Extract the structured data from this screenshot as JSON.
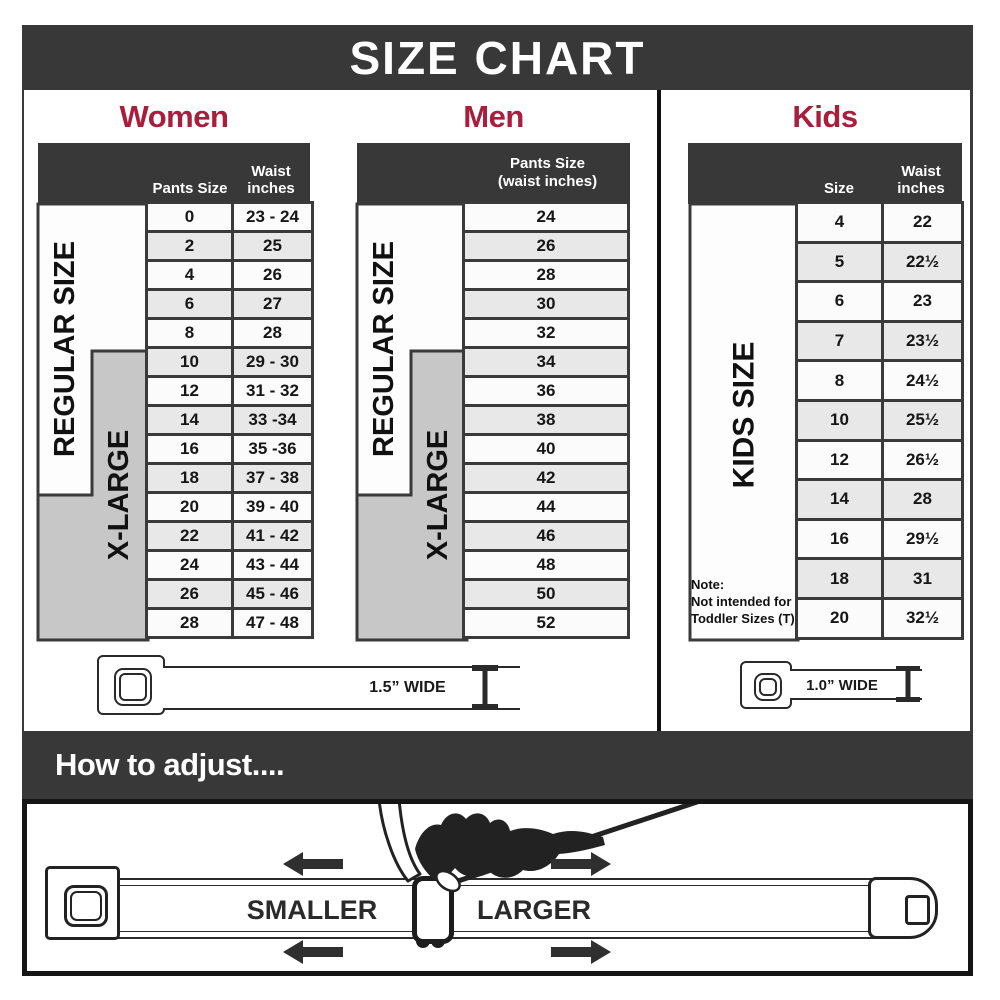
{
  "title": "SIZE CHART",
  "colors": {
    "accent": "#A81E3C",
    "dark_bar": "#383838",
    "table_border": "#3A3A3A",
    "xlarge_gray": "#C7C7C7"
  },
  "women": {
    "heading": "Women",
    "regular_label": "REGULAR SIZE",
    "xlarge_label": "X-LARGE",
    "columns": [
      "Pants Size",
      "Waist inches"
    ],
    "rows": [
      {
        "pants_size": "0",
        "waist": "23 - 24"
      },
      {
        "pants_size": "2",
        "waist": "25"
      },
      {
        "pants_size": "4",
        "waist": "26"
      },
      {
        "pants_size": "6",
        "waist": "27"
      },
      {
        "pants_size": "8",
        "waist": "28"
      },
      {
        "pants_size": "10",
        "waist": "29 - 30"
      },
      {
        "pants_size": "12",
        "waist": "31 - 32"
      },
      {
        "pants_size": "14",
        "waist": "33 -34"
      },
      {
        "pants_size": "16",
        "waist": "35 -36"
      },
      {
        "pants_size": "18",
        "waist": "37 - 38"
      },
      {
        "pants_size": "20",
        "waist": "39 - 40"
      },
      {
        "pants_size": "22",
        "waist": "41 - 42"
      },
      {
        "pants_size": "24",
        "waist": "43 - 44"
      },
      {
        "pants_size": "26",
        "waist": "45 - 46"
      },
      {
        "pants_size": "28",
        "waist": "47 - 48"
      }
    ]
  },
  "men": {
    "heading": "Men",
    "regular_label": "REGULAR SIZE",
    "xlarge_label": "X-LARGE",
    "column_header": "Pants Size (waist inches)",
    "rows": [
      "24",
      "26",
      "28",
      "30",
      "32",
      "34",
      "36",
      "38",
      "40",
      "42",
      "44",
      "46",
      "48",
      "50",
      "52"
    ]
  },
  "kids": {
    "heading": "Kids",
    "side_label": "KIDS SIZE",
    "columns": [
      "Size",
      "Waist inches"
    ],
    "rows": [
      {
        "size": "4",
        "waist": "22"
      },
      {
        "size": "5",
        "waist": "22½"
      },
      {
        "size": "6",
        "waist": "23"
      },
      {
        "size": "7",
        "waist": "23½"
      },
      {
        "size": "8",
        "waist": "24½"
      },
      {
        "size": "10",
        "waist": "25½"
      },
      {
        "size": "12",
        "waist": "26½"
      },
      {
        "size": "14",
        "waist": "28"
      },
      {
        "size": "16",
        "waist": "29½"
      },
      {
        "size": "18",
        "waist": "31"
      },
      {
        "size": "20",
        "waist": "32½"
      }
    ],
    "note": "Note:\nNot intended for\nToddler Sizes (T)"
  },
  "belts": {
    "adult_width_label": "1.5” WIDE",
    "kids_width_label": "1.0” WIDE"
  },
  "adjust": {
    "heading": "How to adjust....",
    "smaller_label": "SMALLER",
    "larger_label": "LARGER"
  }
}
